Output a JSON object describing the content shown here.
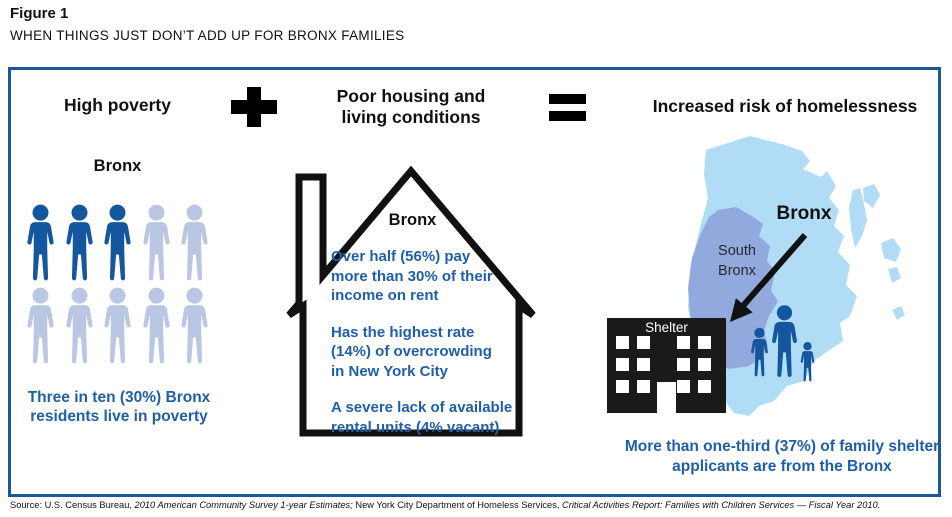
{
  "figure": {
    "label": "Figure 1",
    "title": "WHEN THINGS JUST DON’T ADD UP FOR BRONX FAMILIES"
  },
  "equation": {
    "left_title": "High poverty",
    "plus": "+",
    "middle_title": "Poor housing and living conditions",
    "equals": "=",
    "right_title": "Increased risk of homelessness"
  },
  "poverty_panel": {
    "region_label": "Bronx",
    "total_icons": 10,
    "highlighted_icons": 3,
    "caption": "Three in ten (30%) Bronx residents live in poverty"
  },
  "housing_panel": {
    "region_label": "Bronx",
    "facts": [
      {
        "lines": [
          "Over half (56%) pay",
          "more than 30% of their",
          "income on rent"
        ]
      },
      {
        "lines": [
          "Has the highest rate",
          "(14%) of overcrowding",
          "in New York City"
        ]
      },
      {
        "lines": [
          "A severe lack of available",
          "rental units (4% vacant)"
        ]
      }
    ]
  },
  "homelessness_panel": {
    "map_label": "Bronx",
    "submap_label": "South Bronx",
    "shelter_label": "Shelter",
    "caption": "More than one-third (37%) of family shelter applicants are from the Bronx"
  },
  "source": {
    "prefix": "Source: U.S. Census Bureau, ",
    "cite1": "2010 American Community Survey 1-year Estimates;",
    "middle": " New York City Department of Homeless Services, ",
    "cite2": "Critical Activities Report: Families with Children Services — Fiscal Year 2010."
  },
  "colors": {
    "border_blue": "#1f5796",
    "text_blue": "#1e5fa9",
    "person_dark": "#15579e",
    "person_light": "#bac7e2",
    "map_light": "#b0dcf5",
    "map_south": "#92a9de"
  }
}
